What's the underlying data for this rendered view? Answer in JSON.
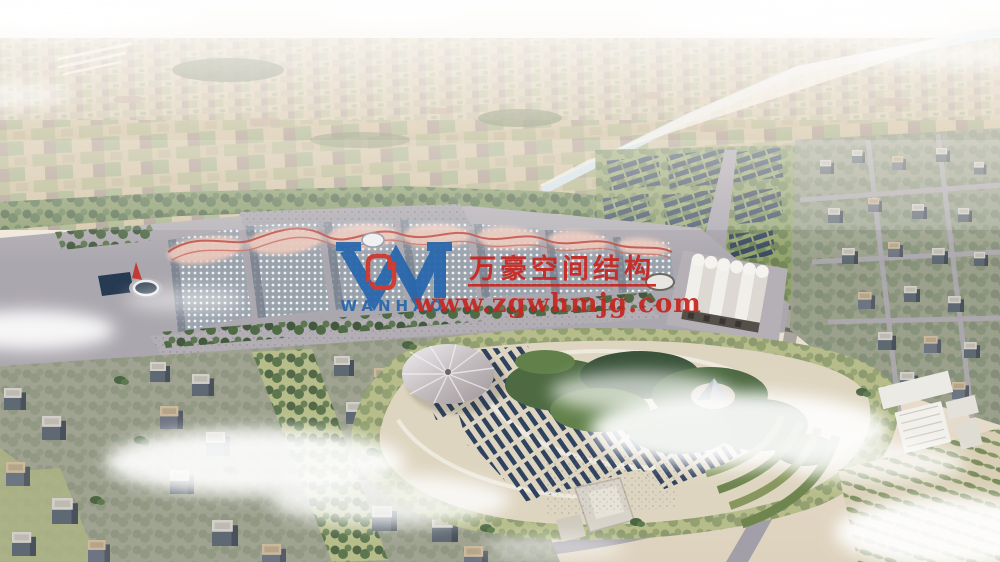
{
  "watermark": {
    "company_name": "万豪空间结构",
    "website": "www.zgwhmjg.com",
    "logo_text": "WANHAO",
    "accent_red": "#c8241e",
    "logo_blue": "#2566ac"
  },
  "palette": {
    "sky_top": "#f8f6f2",
    "haze": "#ece0d4",
    "farmland_base": "#cfc1a4",
    "canal": "#cfe0ea",
    "tree_green": "#4c6644",
    "lawn_green": "#b6bd8a",
    "road_gray": "#a39fa8",
    "paving_gray": "#aba7ae",
    "hall_roof_gray": "#9aa2ac",
    "canopy_pink": "#e9c6ba",
    "ridge_red": "#bd4a40",
    "solar_panel_navy": "#36475d",
    "park_sand": "#ded5c0",
    "station_roof_white": "#f1efe9",
    "building_face": "#5f6973",
    "building_roof": "#d2cfc8",
    "cloud_white": "#ffffff"
  }
}
